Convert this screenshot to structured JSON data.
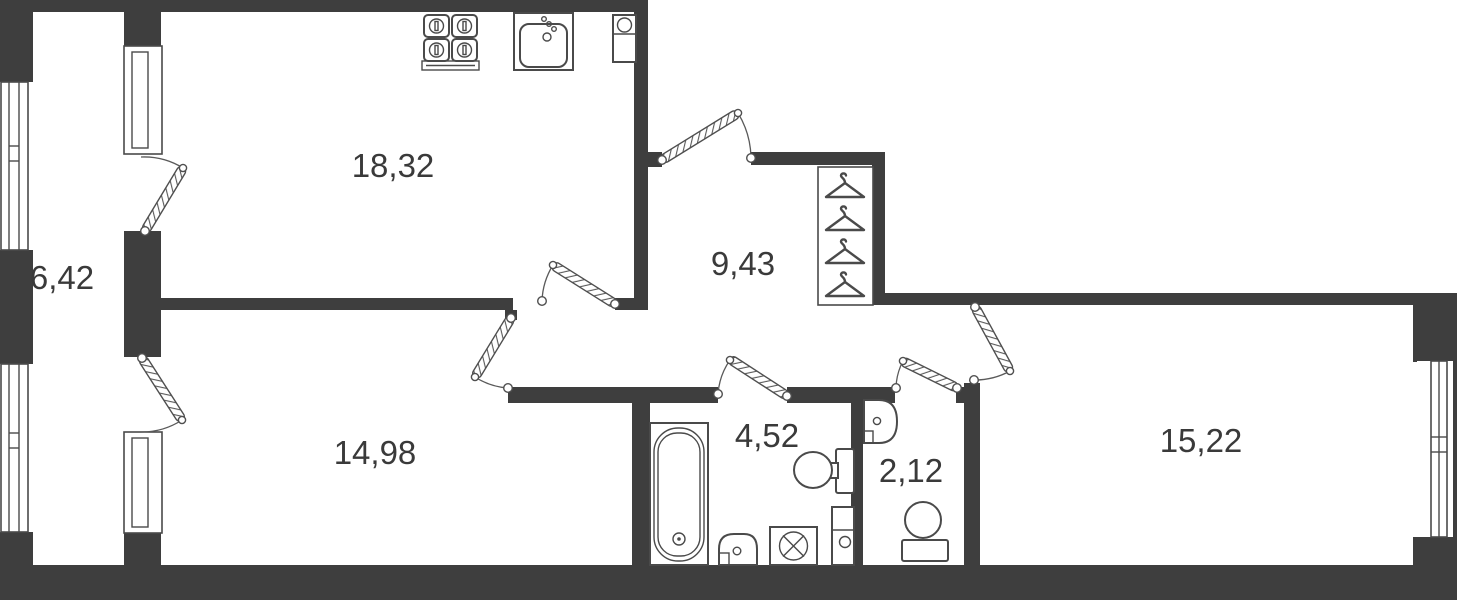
{
  "floor_plan": {
    "rooms": {
      "kitchen_living": {
        "label": "18,32"
      },
      "balcony": {
        "label": "6,42"
      },
      "hallway": {
        "label": "9,43"
      },
      "bedroom_left": {
        "label": "14,98"
      },
      "bathroom": {
        "label": "4,52"
      },
      "wc": {
        "label": "2,12"
      },
      "bedroom_right": {
        "label": "15,22"
      }
    },
    "colors": {
      "wall": "#3e3e3e",
      "outline": "#4a4a4a",
      "label_text": "#3a3a3a",
      "background": "#ffffff"
    },
    "fixtures": [
      "stove",
      "kitchen-sink",
      "vent-box",
      "wardrobe-hangers",
      "bathtub",
      "toilet",
      "washbasin",
      "washing-machine",
      "duct",
      "wc-toilet",
      "wc-washbasin"
    ]
  }
}
